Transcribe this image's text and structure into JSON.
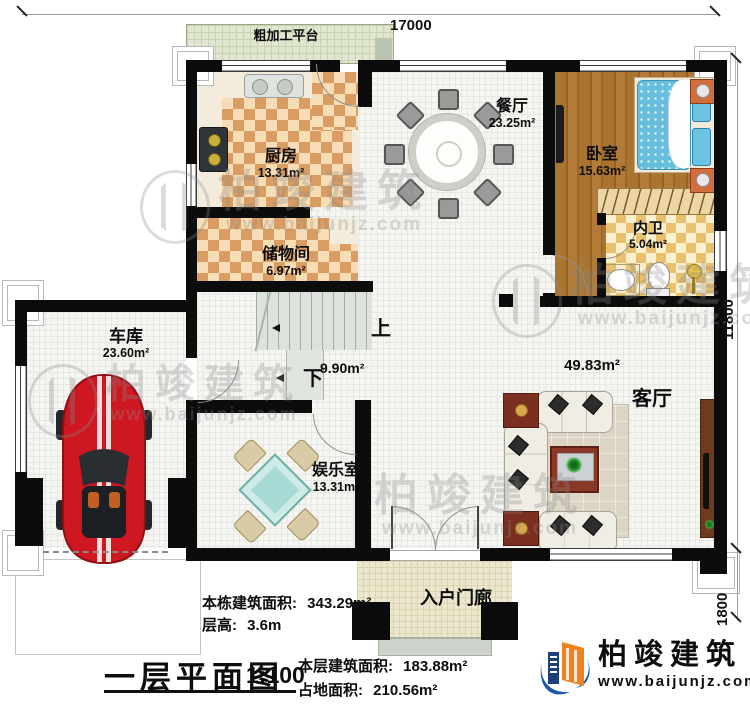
{
  "dimensions": {
    "top": "17000",
    "right_upper": "11800",
    "right_lower": "1800"
  },
  "platform": {
    "label": "粗加工平台"
  },
  "rooms": {
    "kitchen": {
      "name": "厨房",
      "area": "13.31m²"
    },
    "storage": {
      "name": "储物间",
      "area": "6.97m²"
    },
    "dining": {
      "name": "餐厅",
      "area": "23.25m²"
    },
    "bedroom": {
      "name": "卧室",
      "area": "15.63m²"
    },
    "bath": {
      "name": "内卫",
      "area": "5.04m²"
    },
    "garage": {
      "name": "车库",
      "area": "23.60m²"
    },
    "entertainment": {
      "name": "娱乐室",
      "area": "13.31m²"
    },
    "living": {
      "name": "客厅",
      "area": "49.83m²"
    },
    "stairs": {
      "area": "9.90m²",
      "up": "上",
      "down": "下"
    },
    "porch": {
      "name": "入户门廊"
    }
  },
  "summary": {
    "building_area_label": "本栋建筑面积:",
    "building_area_value": "343.29m²",
    "floor_height_label": "层高:",
    "floor_height_value": "3.6m",
    "title": "一层平面图",
    "scale": "1:100",
    "floor_area_label": "本层建筑面积:",
    "floor_area_value": "183.88m²",
    "footprint_label": "占地面积:",
    "footprint_value": "210.56m²"
  },
  "brand": {
    "name": "柏竣建筑",
    "website": "www.baijunjz.com"
  },
  "watermark": {
    "text": "柏竣建筑",
    "website": "www.baijunjz.com"
  }
}
